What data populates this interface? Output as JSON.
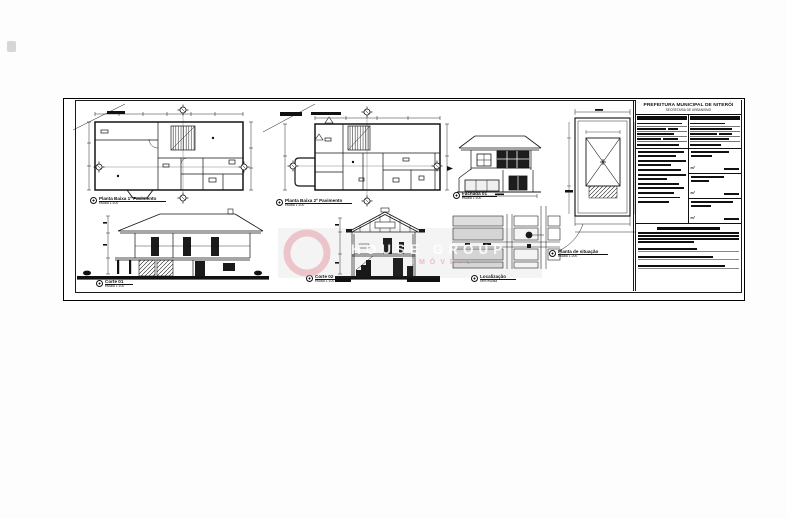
{
  "sheet": {
    "title_block": {
      "org_line1": "PREFEITURA MUNICIPAL DE NITERÓI",
      "org_line2": "SECRETARIA DE URBANISMO",
      "unit_label": "m²"
    },
    "labels": {
      "planta1": {
        "title": "Planta Baixa 1º Pavimento",
        "scale": "escala  1:100"
      },
      "planta2": {
        "title": "Planta Baixa 2º Pavimento",
        "scale": "escala  1:100"
      },
      "fachada": {
        "title": "Fachada 01",
        "scale": "escala  1:100"
      },
      "corte1": {
        "title": "Corte 01",
        "scale": "escala  1:100"
      },
      "corte2": {
        "title": "Corte 02",
        "scale": "escala  1:100"
      },
      "localizacao": {
        "title": "Localização",
        "scale": "sem escala"
      },
      "situacao": {
        "title": "Planta de situação",
        "scale": "escala  1:200"
      }
    },
    "watermark": {
      "line1": "HOUSE GROUP",
      "line2": "IMÓVEIS"
    }
  }
}
